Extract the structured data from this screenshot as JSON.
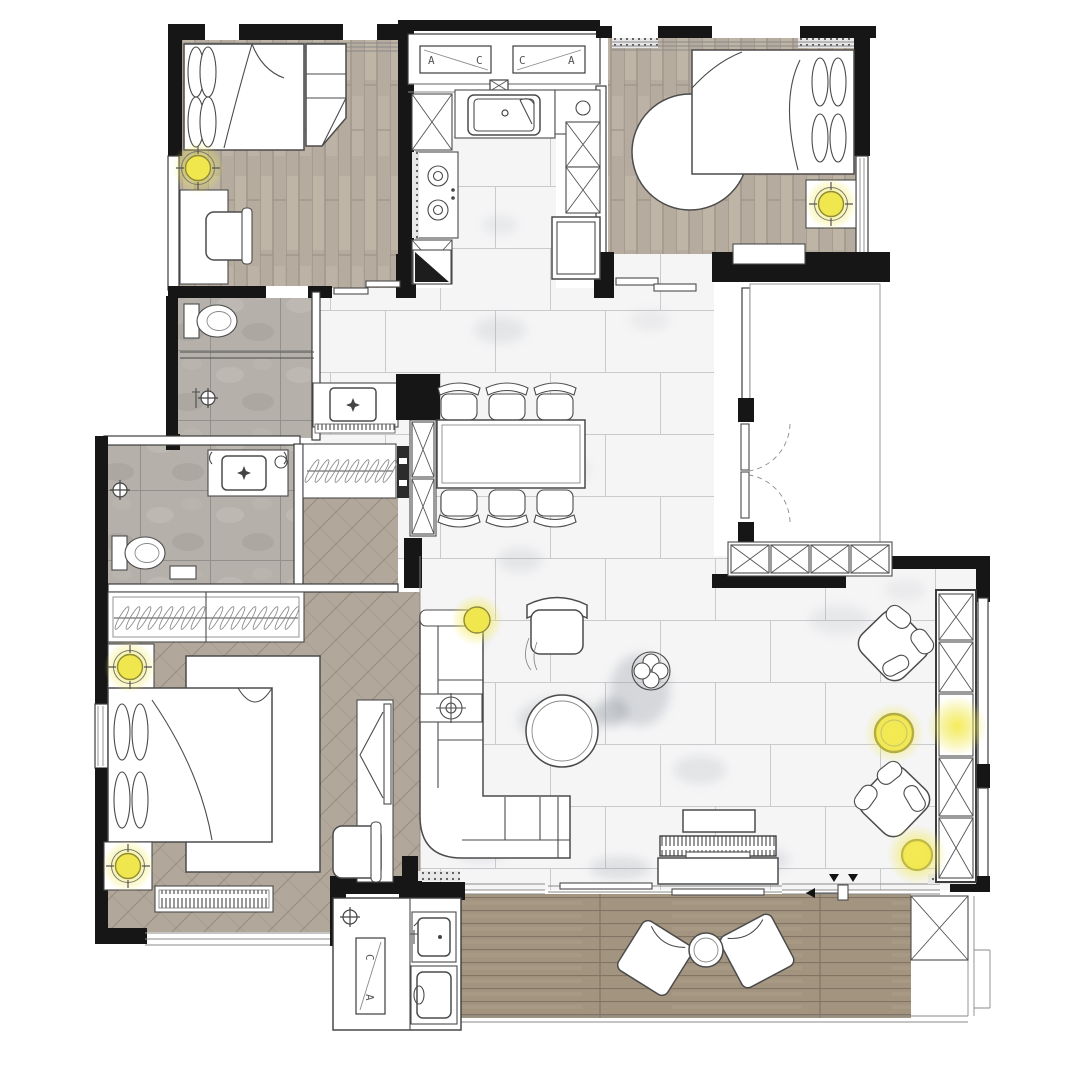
{
  "drawing_type": "residential-apartment-floor-plan-top-view",
  "section_markers": {
    "kitchen_left": {
      "a": "A",
      "b": "C"
    },
    "kitchen_right": {
      "a": "C",
      "b": "A"
    },
    "balcony": {
      "a": "C",
      "b": "A"
    }
  },
  "palette": {
    "wall": "#161616",
    "ink": "#4b4b4b",
    "line-light": "#8a8a8a",
    "wood": "#b5ab9e",
    "wood-light": "#cdc3b5",
    "wood-line": "#988e82",
    "herr": "#b1a79a",
    "herr-line": "#968c7f",
    "deck": "#a2947f",
    "deck-line": "#837363",
    "stone": "#b5b1aa",
    "stone-line": "#92908a",
    "marble": "#f5f5f6",
    "marble-line": "#c9cacd",
    "vein": "#9aa0a8",
    "accent": "#f0e74e",
    "accent-ring": "#8e8a3c"
  },
  "lights": [
    {
      "name": "bedroom2-floor-lamp",
      "x": 198,
      "y": 168,
      "style": "crosshair"
    },
    {
      "name": "bedroom3-nightstand-lamp",
      "x": 831,
      "y": 204,
      "style": "crosshair"
    },
    {
      "name": "master-nightstand-lamp-1",
      "x": 130,
      "y": 667,
      "style": "crosshair"
    },
    {
      "name": "master-nightstand-lamp-2",
      "x": 128,
      "y": 866,
      "style": "crosshair"
    },
    {
      "name": "sofa-corner-lamp",
      "x": 477,
      "y": 620,
      "style": "plain"
    },
    {
      "name": "side-table-lamp-1",
      "x": 894,
      "y": 733,
      "style": "glow-only"
    },
    {
      "name": "shelf-niche-light",
      "x": 957,
      "y": 726,
      "style": "glow-only"
    },
    {
      "name": "side-table-lamp-2",
      "x": 917,
      "y": 855,
      "style": "glow-only"
    }
  ],
  "legend": {
    "fixtures": [
      "double-bed-x3",
      "round-rug",
      "dining-table-with-6-chairs",
      "l-shaped-sofa",
      "lounge-armchair-x3",
      "round-coffee-table",
      "clover-side-table",
      "tv-console",
      "kitchen-sink",
      "gas-stove",
      "refrigerator",
      "tall-cabinet-x-units",
      "toilet-x2",
      "vanity-basin-x3",
      "shower-x2",
      "hanging-wardrobe-x3",
      "washing-machine",
      "laundry-sink",
      "balcony-deck",
      "bean-bag-x2",
      "entry-double-door"
    ]
  }
}
